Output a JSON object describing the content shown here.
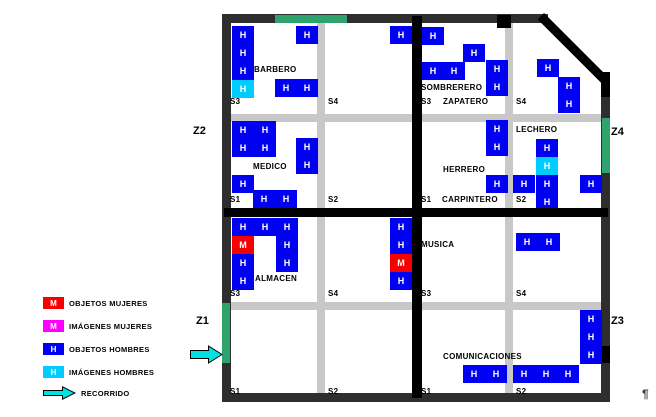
{
  "colors": {
    "objetos_hombres_blue": "#0000f2",
    "imagenes_hombres_cyan": "#00ccff",
    "objetos_mujeres_red": "#f80000",
    "imagenes_mujeres_magenta": "#ff00ff",
    "gate_green": "#2ea36e",
    "road_gray": "#c8c8c8",
    "wall_black": "#000000",
    "border_dark": "#2e2e2e",
    "arrow_cyan": "#00e2e2"
  },
  "legend": {
    "items": [
      {
        "symbol": "M",
        "color": "#f80000",
        "label": "OBJETOS MUJERES"
      },
      {
        "symbol": "M",
        "color": "#ff00ff",
        "label": "IMÁGENES MUJERES"
      },
      {
        "symbol": "H",
        "color": "#0000f2",
        "label": "OBJETOS HOMBRES"
      },
      {
        "symbol": "H",
        "color": "#00ccff",
        "label": "IMÁGENES HOMBRES"
      }
    ],
    "arrow_label": "RECORRIDO"
  },
  "zones": [
    {
      "id": "Z1",
      "x": 196,
      "y": 316
    },
    {
      "id": "Z2",
      "x": 193,
      "y": 126
    },
    {
      "id": "Z3",
      "x": 611,
      "y": 316
    },
    {
      "id": "Z4",
      "x": 611,
      "y": 127
    }
  ],
  "marks": {
    "pilcrow": "¶"
  },
  "map": {
    "borders": [
      {
        "name": "border-top",
        "x": 222,
        "y": 14,
        "w": 326,
        "h": 9
      },
      {
        "name": "border-left",
        "x": 222,
        "y": 14,
        "w": 9,
        "h": 388
      },
      {
        "name": "border-bottom",
        "x": 222,
        "y": 393,
        "w": 388,
        "h": 9
      },
      {
        "name": "border-right",
        "x": 601,
        "y": 90,
        "w": 9,
        "h": 312
      }
    ],
    "walls": [
      {
        "name": "divider-vertical",
        "x": 412,
        "y": 16,
        "w": 10,
        "h": 382
      },
      {
        "name": "divider-horizontal",
        "x": 224,
        "y": 208,
        "w": 384,
        "h": 9
      },
      {
        "name": "corner-diagonal",
        "x": 544,
        "y": 13,
        "w": 90,
        "h": 9,
        "rotate": 45
      },
      {
        "name": "wall-right-upper",
        "x": 601,
        "y": 72,
        "w": 9,
        "h": 25
      },
      {
        "name": "wall-top-road-block",
        "x": 497,
        "y": 15,
        "w": 14,
        "h": 13
      },
      {
        "name": "wall-right-z3-block",
        "x": 600,
        "y": 346,
        "w": 10,
        "h": 17
      }
    ],
    "gates": [
      {
        "name": "gate-top-z2",
        "x": 275,
        "y": 15,
        "w": 72,
        "h": 8
      },
      {
        "name": "gate-right-z4",
        "x": 602,
        "y": 118,
        "w": 8,
        "h": 55
      },
      {
        "name": "gate-left-z1",
        "x": 222,
        "y": 303,
        "w": 8,
        "h": 60
      }
    ],
    "roads": [
      {
        "name": "road-nw-vertical",
        "x": 317,
        "y": 23,
        "w": 8,
        "h": 185
      },
      {
        "name": "road-nw-horizontal",
        "x": 231,
        "y": 114,
        "w": 181,
        "h": 8
      },
      {
        "name": "road-ne-vertical",
        "x": 505,
        "y": 23,
        "w": 8,
        "h": 185
      },
      {
        "name": "road-ne-horizontal",
        "x": 422,
        "y": 114,
        "w": 180,
        "h": 8
      },
      {
        "name": "road-sw-vertical",
        "x": 317,
        "y": 217,
        "w": 8,
        "h": 176
      },
      {
        "name": "road-sw-horizontal",
        "x": 231,
        "y": 302,
        "w": 181,
        "h": 8
      },
      {
        "name": "road-se-vertical",
        "x": 505,
        "y": 217,
        "w": 8,
        "h": 176
      },
      {
        "name": "road-se-horizontal",
        "x": 422,
        "y": 302,
        "w": 180,
        "h": 8
      }
    ],
    "labels": [
      {
        "text": "BARBERO",
        "x": 254,
        "y": 66
      },
      {
        "text": "S3",
        "x": 230,
        "y": 98
      },
      {
        "text": "S4",
        "x": 328,
        "y": 98
      },
      {
        "text": "MEDICO",
        "x": 253,
        "y": 163
      },
      {
        "text": "S1",
        "x": 230,
        "y": 196
      },
      {
        "text": "S2",
        "x": 328,
        "y": 196
      },
      {
        "text": "SOMBRERERO",
        "x": 421,
        "y": 84
      },
      {
        "text": "S3",
        "x": 421,
        "y": 98
      },
      {
        "text": "ZAPATERO",
        "x": 443,
        "y": 98
      },
      {
        "text": "S4",
        "x": 516,
        "y": 98
      },
      {
        "text": "HERRERO",
        "x": 443,
        "y": 166
      },
      {
        "text": "LECHERO",
        "x": 516,
        "y": 126
      },
      {
        "text": "S1",
        "x": 421,
        "y": 196
      },
      {
        "text": "CARPINTERO",
        "x": 442,
        "y": 196
      },
      {
        "text": "S2",
        "x": 516,
        "y": 196
      },
      {
        "text": "ALMACEN",
        "x": 255,
        "y": 275
      },
      {
        "text": "S3",
        "x": 230,
        "y": 290
      },
      {
        "text": "S4",
        "x": 328,
        "y": 290
      },
      {
        "text": "S1",
        "x": 230,
        "y": 388
      },
      {
        "text": "S2",
        "x": 328,
        "y": 388
      },
      {
        "text": "MUSICA",
        "x": 421,
        "y": 241
      },
      {
        "text": "S3",
        "x": 421,
        "y": 290
      },
      {
        "text": "S4",
        "x": 516,
        "y": 290
      },
      {
        "text": "COMUNICACIONES",
        "x": 443,
        "y": 353
      },
      {
        "text": "S1",
        "x": 421,
        "y": 388
      },
      {
        "text": "S2",
        "x": 516,
        "y": 388
      }
    ],
    "tiles": [
      {
        "x": 232,
        "y": 26,
        "t": "H",
        "c": "blue"
      },
      {
        "x": 232,
        "y": 44,
        "t": "H",
        "c": "blue"
      },
      {
        "x": 232,
        "y": 62,
        "t": "H",
        "c": "blue"
      },
      {
        "x": 232,
        "y": 80,
        "t": "H",
        "c": "cyan"
      },
      {
        "x": 296,
        "y": 26,
        "t": "H",
        "c": "blue"
      },
      {
        "x": 275,
        "y": 79,
        "t": "H",
        "c": "blue"
      },
      {
        "x": 296,
        "y": 79,
        "t": "H",
        "c": "blue"
      },
      {
        "x": 390,
        "y": 26,
        "t": "H",
        "c": "blue"
      },
      {
        "x": 422,
        "y": 27,
        "t": "H",
        "c": "blue"
      },
      {
        "x": 463,
        "y": 44,
        "t": "H",
        "c": "blue"
      },
      {
        "x": 422,
        "y": 62,
        "t": "H",
        "c": "blue"
      },
      {
        "x": 443,
        "y": 62,
        "t": "H",
        "c": "blue"
      },
      {
        "x": 486,
        "y": 60,
        "t": "H",
        "c": "blue"
      },
      {
        "x": 486,
        "y": 78,
        "t": "H",
        "c": "blue"
      },
      {
        "x": 537,
        "y": 59,
        "t": "H",
        "c": "blue"
      },
      {
        "x": 558,
        "y": 77,
        "t": "H",
        "c": "blue"
      },
      {
        "x": 558,
        "y": 95,
        "t": "H",
        "c": "blue"
      },
      {
        "x": 232,
        "y": 121,
        "t": "H",
        "c": "blue"
      },
      {
        "x": 254,
        "y": 121,
        "t": "H",
        "c": "blue"
      },
      {
        "x": 232,
        "y": 139,
        "t": "H",
        "c": "blue"
      },
      {
        "x": 254,
        "y": 139,
        "t": "H",
        "c": "blue"
      },
      {
        "x": 296,
        "y": 138,
        "t": "H",
        "c": "blue"
      },
      {
        "x": 296,
        "y": 156,
        "t": "H",
        "c": "blue"
      },
      {
        "x": 232,
        "y": 175,
        "t": "H",
        "c": "blue"
      },
      {
        "x": 253,
        "y": 190,
        "t": "H",
        "c": "blue"
      },
      {
        "x": 275,
        "y": 190,
        "t": "H",
        "c": "blue"
      },
      {
        "x": 486,
        "y": 120,
        "t": "H",
        "c": "blue"
      },
      {
        "x": 486,
        "y": 138,
        "t": "H",
        "c": "blue"
      },
      {
        "x": 536,
        "y": 139,
        "t": "H",
        "c": "blue"
      },
      {
        "x": 536,
        "y": 157,
        "t": "H",
        "c": "cyan"
      },
      {
        "x": 486,
        "y": 175,
        "t": "H",
        "c": "blue"
      },
      {
        "x": 513,
        "y": 175,
        "t": "H",
        "c": "blue"
      },
      {
        "x": 536,
        "y": 175,
        "t": "H",
        "c": "blue"
      },
      {
        "x": 580,
        "y": 175,
        "t": "H",
        "c": "blue"
      },
      {
        "x": 536,
        "y": 193,
        "t": "H",
        "c": "blue",
        "h": 15
      },
      {
        "x": 232,
        "y": 218,
        "t": "H",
        "c": "blue"
      },
      {
        "x": 254,
        "y": 218,
        "t": "H",
        "c": "blue"
      },
      {
        "x": 276,
        "y": 218,
        "t": "H",
        "c": "blue"
      },
      {
        "x": 232,
        "y": 236,
        "t": "M",
        "c": "red"
      },
      {
        "x": 276,
        "y": 236,
        "t": "H",
        "c": "blue"
      },
      {
        "x": 232,
        "y": 254,
        "t": "H",
        "c": "blue"
      },
      {
        "x": 276,
        "y": 254,
        "t": "H",
        "c": "blue"
      },
      {
        "x": 232,
        "y": 272,
        "t": "H",
        "c": "blue"
      },
      {
        "x": 390,
        "y": 218,
        "t": "H",
        "c": "blue"
      },
      {
        "x": 390,
        "y": 236,
        "t": "H",
        "c": "blue"
      },
      {
        "x": 390,
        "y": 254,
        "t": "M",
        "c": "red"
      },
      {
        "x": 390,
        "y": 272,
        "t": "H",
        "c": "blue"
      },
      {
        "x": 516,
        "y": 233,
        "t": "H",
        "c": "blue"
      },
      {
        "x": 538,
        "y": 233,
        "t": "H",
        "c": "blue"
      },
      {
        "x": 463,
        "y": 365,
        "t": "H",
        "c": "blue"
      },
      {
        "x": 485,
        "y": 365,
        "t": "H",
        "c": "blue"
      },
      {
        "x": 513,
        "y": 365,
        "t": "H",
        "c": "blue"
      },
      {
        "x": 535,
        "y": 365,
        "t": "H",
        "c": "blue"
      },
      {
        "x": 557,
        "y": 365,
        "t": "H",
        "c": "blue"
      },
      {
        "x": 580,
        "y": 310,
        "t": "H",
        "c": "blue"
      },
      {
        "x": 580,
        "y": 328,
        "t": "H",
        "c": "blue"
      },
      {
        "x": 580,
        "y": 346,
        "t": "H",
        "c": "blue"
      }
    ]
  }
}
